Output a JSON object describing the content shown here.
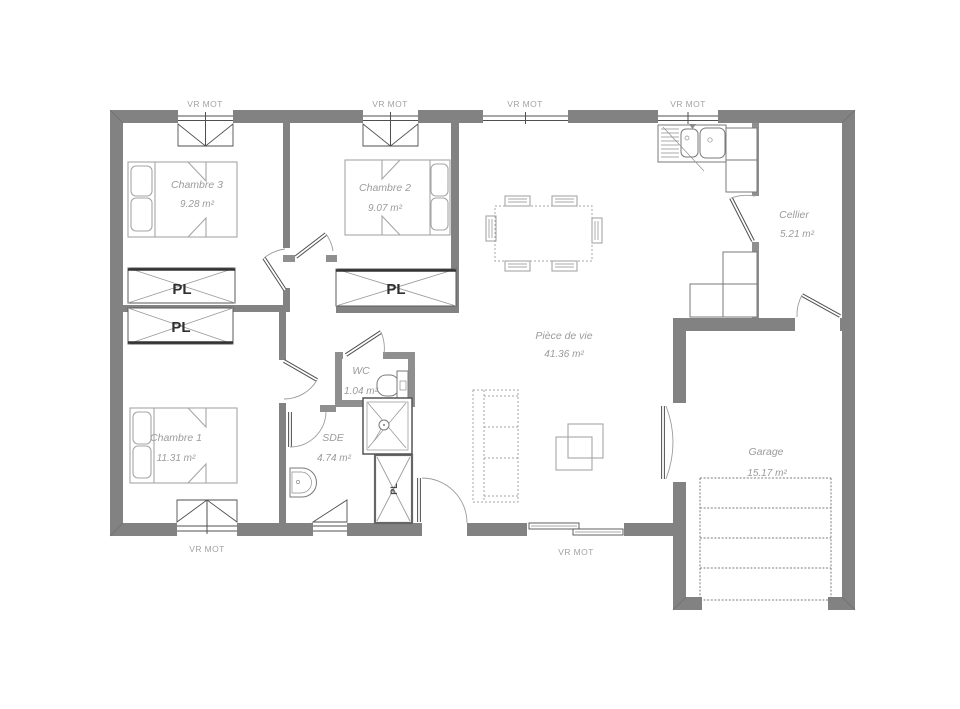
{
  "labels": {
    "vr_mot": "VR MOT",
    "pl": "PL"
  },
  "rooms": {
    "chambre3": {
      "name": "Chambre 3",
      "area": "9.28 m²"
    },
    "chambre2": {
      "name": "Chambre 2",
      "area": "9.07 m²"
    },
    "chambre1": {
      "name": "Chambre 1",
      "area": "11.31 m²"
    },
    "piece_de_vie": {
      "name": "Pièce de vie",
      "area": "41.36 m²"
    },
    "cellier": {
      "name": "Cellier",
      "area": "5.21 m²"
    },
    "wc": {
      "name": "WC",
      "area": "1.04 m²"
    },
    "sde": {
      "name": "SDE",
      "area": "4.74 m²"
    },
    "garage": {
      "name": "Garage",
      "area": "15.17 m²"
    }
  },
  "colors": {
    "wall": "#828282",
    "partition": "#8f8f8f",
    "line": "#4f4f4f",
    "furniture": "#a6a6a6",
    "label": "#9b9b9b",
    "pl_label": "#2f2f2f"
  }
}
